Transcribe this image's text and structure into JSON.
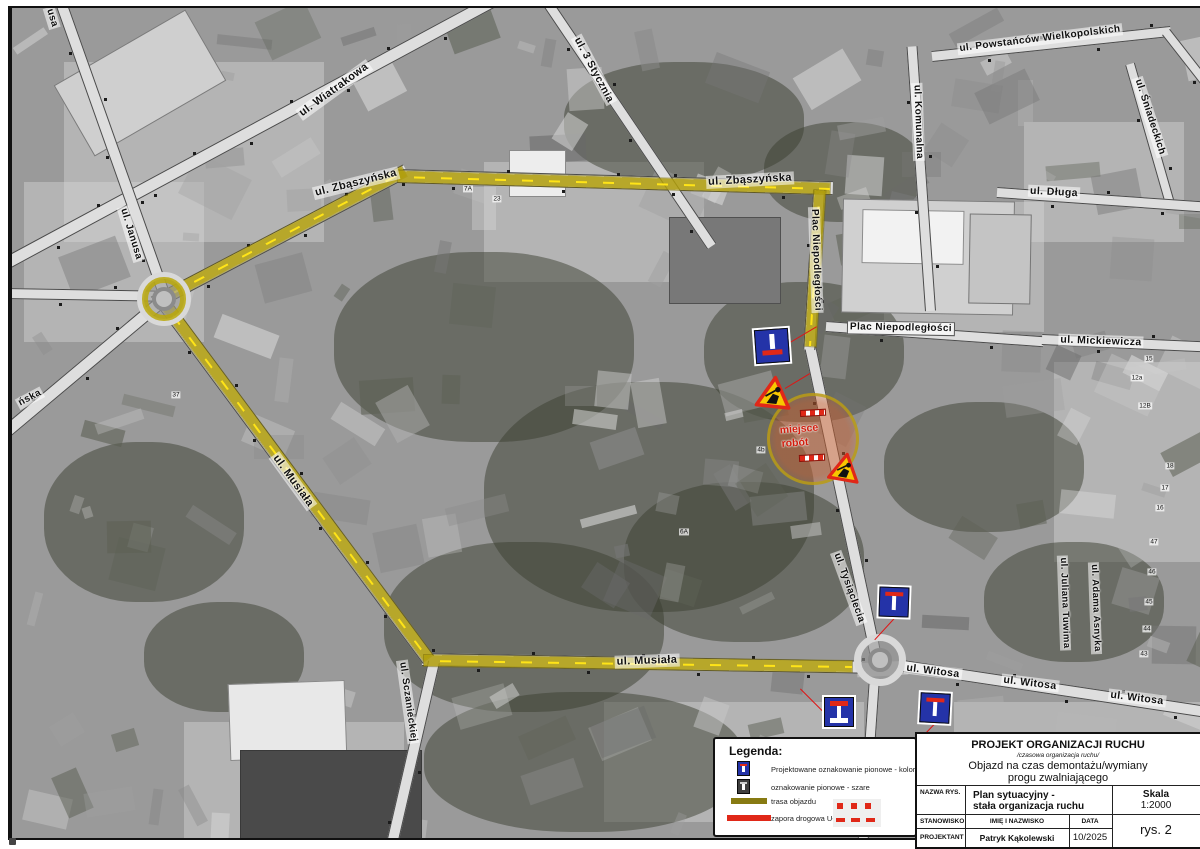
{
  "title_block": {
    "header": "PROJEKT ORGANIZACJI RUCHU",
    "subheader": "/czasowa organizacja ruchu/",
    "subject_line1": "Objazd na czas demontażu/wymiany",
    "subject_line2": "progu zwalniającego",
    "nazwa_rys_label": "NAZWA RYS.",
    "nazwa_rys_value1": "Plan sytuacyjny -",
    "nazwa_rys_value2": "stała organizacja ruchu",
    "skala_label": "Skala",
    "skala_value": "1:2000",
    "stanowisko_label": "STANOWISKO",
    "imie_label": "IMIĘ I NAZWISKO",
    "data_label": "DATA",
    "projektant_label": "PROJEKTANT",
    "projektant_value": "Patryk Kąkolewski",
    "data_value": "10/2025",
    "rys_value": "rys. 2"
  },
  "legend": {
    "title": "Legenda:",
    "items": [
      {
        "icon": "sign-blue-icon",
        "label": "Projektowane oznakowanie pionowe - kolor"
      },
      {
        "icon": "sign-gray-icon",
        "label": "oznakowanie pionowe - szare"
      },
      {
        "icon": "route-swatch",
        "label": "trasa objazdu"
      },
      {
        "icon": "barrier-swatch",
        "label": "zapora drogowa U-20a"
      }
    ]
  },
  "map": {
    "street_labels": [
      {
        "text": "ul. Zbąszyńska",
        "x": 352,
        "y": 181,
        "rot": -14,
        "fs": 11
      },
      {
        "text": "ul. Zbąszyńska",
        "x": 746,
        "y": 178,
        "rot": -3,
        "fs": 11
      },
      {
        "text": "ul. Wiatrakowa",
        "x": 330,
        "y": 88,
        "rot": -36,
        "fs": 11
      },
      {
        "text": "ul. 3 Stycznia",
        "x": 590,
        "y": 68,
        "rot": 62,
        "fs": 10.5
      },
      {
        "text": "ul. Powstańców Wielkopolskich",
        "x": 1036,
        "y": 37,
        "rot": -7,
        "fs": 10
      },
      {
        "text": "ul. Komunalna",
        "x": 914,
        "y": 120,
        "rot": 88,
        "fs": 10
      },
      {
        "text": "ul. Śniadeckich",
        "x": 1146,
        "y": 115,
        "rot": 72,
        "fs": 10
      },
      {
        "text": "ul. Długa",
        "x": 1050,
        "y": 190,
        "rot": 3,
        "fs": 10.5
      },
      {
        "text": "ul. Mickiewicza",
        "x": 1097,
        "y": 339,
        "rot": 2,
        "fs": 10.5
      },
      {
        "text": "Plac Niepodległości",
        "x": 897,
        "y": 326,
        "rot": 1,
        "fs": 10,
        "boxed": true
      },
      {
        "text": "Plac Niepodległości",
        "x": 812,
        "y": 258,
        "rot": 88,
        "fs": 10
      },
      {
        "text": "ul. Tysiąclecia",
        "x": 845,
        "y": 586,
        "rot": 70,
        "fs": 10
      },
      {
        "text": "ul. Juliana Tuwima",
        "x": 1060,
        "y": 601,
        "rot": 88,
        "fs": 9.5
      },
      {
        "text": "ul. Adama Asnyka",
        "x": 1091,
        "y": 606,
        "rot": 88,
        "fs": 9.5
      },
      {
        "text": "ul. Musiała",
        "x": 289,
        "y": 479,
        "rot": 54,
        "fs": 11
      },
      {
        "text": "ul. Musiała",
        "x": 643,
        "y": 659,
        "rot": -2,
        "fs": 11
      },
      {
        "text": "ul. Witosa",
        "x": 929,
        "y": 669,
        "rot": 7,
        "fs": 10.5
      },
      {
        "text": "ul. Witosa",
        "x": 1026,
        "y": 681,
        "rot": 7,
        "fs": 10.5
      },
      {
        "text": "ul. Witosa",
        "x": 1133,
        "y": 696,
        "rot": 7,
        "fs": 10.5
      },
      {
        "text": "ul. Janusa",
        "x": 127,
        "y": 232,
        "rot": 73,
        "fs": 10
      },
      {
        "text": "ul. Sczanieckiej",
        "x": 404,
        "y": 700,
        "rot": 82,
        "fs": 10
      },
      {
        "text": "ńska",
        "x": 26,
        "y": 396,
        "rot": -28,
        "fs": 10
      },
      {
        "text": "usa",
        "x": 48,
        "y": 16,
        "rot": 73,
        "fs": 10
      }
    ],
    "parcel_numbers": [
      {
        "text": "7A",
        "x": 464,
        "y": 187
      },
      {
        "text": "23",
        "x": 493,
        "y": 197
      },
      {
        "text": "37",
        "x": 172,
        "y": 393
      },
      {
        "text": "15",
        "x": 1145,
        "y": 357
      },
      {
        "text": "12a",
        "x": 1133,
        "y": 376
      },
      {
        "text": "12B",
        "x": 1141,
        "y": 404
      },
      {
        "text": "18",
        "x": 1166,
        "y": 464
      },
      {
        "text": "17",
        "x": 1161,
        "y": 486
      },
      {
        "text": "16",
        "x": 1156,
        "y": 506
      },
      {
        "text": "47",
        "x": 1150,
        "y": 540
      },
      {
        "text": "46",
        "x": 1148,
        "y": 570
      },
      {
        "text": "45",
        "x": 1145,
        "y": 600
      },
      {
        "text": "44",
        "x": 1143,
        "y": 627
      },
      {
        "text": "43",
        "x": 1140,
        "y": 652
      },
      {
        "text": "4b",
        "x": 757,
        "y": 448
      },
      {
        "text": "6A",
        "x": 680,
        "y": 530
      }
    ],
    "signs": [
      {
        "kind": "no-through-road",
        "variant": "stem-top",
        "x": 768,
        "y": 344,
        "size": 34,
        "rot": -4
      },
      {
        "kind": "no-through-road",
        "variant": "bar-top",
        "x": 890,
        "y": 600,
        "size": 30,
        "rot": 2
      },
      {
        "kind": "no-through-road",
        "variant": "i-serif",
        "x": 835,
        "y": 710,
        "size": 30,
        "rot": 0
      },
      {
        "kind": "no-through-road",
        "variant": "bar-top",
        "x": 931,
        "y": 706,
        "size": 30,
        "rot": 3
      }
    ],
    "roadworks_triangles": [
      {
        "x": 770,
        "y": 390,
        "size": 36,
        "rot": 6
      },
      {
        "x": 841,
        "y": 465,
        "size": 32,
        "rot": 10
      }
    ],
    "barriers": [
      {
        "x": 796,
        "y": 411,
        "w": 26,
        "rot": -3
      },
      {
        "x": 795,
        "y": 456,
        "w": 26,
        "rot": -3
      }
    ],
    "leader_lines": [
      {
        "x1": 786,
        "y1": 340,
        "x2": 813,
        "y2": 324
      },
      {
        "x1": 781,
        "y1": 386,
        "x2": 806,
        "y2": 371
      },
      {
        "x1": 893,
        "y1": 613,
        "x2": 871,
        "y2": 637
      },
      {
        "x1": 831,
        "y1": 721,
        "x2": 796,
        "y2": 686
      },
      {
        "x1": 931,
        "y1": 721,
        "x2": 909,
        "y2": 744
      }
    ],
    "work_zone": {
      "x": 806,
      "y": 434,
      "d": 86,
      "label1": "miejsce",
      "label2": "robót"
    },
    "colors": {
      "route": "#b09e0a",
      "barrier_red": "#e02818",
      "sign_blue": "#2433a8",
      "warning_yellow": "#f7c800"
    }
  }
}
